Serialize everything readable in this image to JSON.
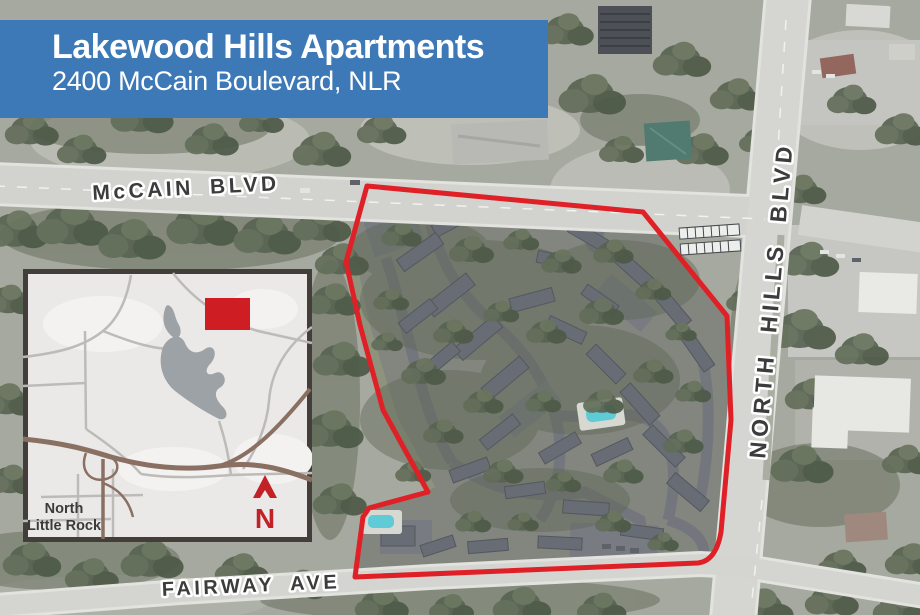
{
  "banner": {
    "title": "Lakewood Hills Apartments",
    "subtitle": "2400 McCain Boulevard, NLR",
    "background_color": "#3d79b6",
    "text_color": "#ffffff"
  },
  "map": {
    "labels": {
      "mccain_blvd": "McCAIN BLVD",
      "north_hills_blvd": "NORTH HILLS BLVD",
      "fairway_ave": "FAIRWAY AVE"
    },
    "boundary_color": "#e01319"
  },
  "inset": {
    "city_label_line1": "North",
    "city_label_line2": "Little Rock",
    "north_arrow_letter": "N",
    "marker_color": "#ce1d23",
    "north_arrow_color": "#c32128"
  }
}
